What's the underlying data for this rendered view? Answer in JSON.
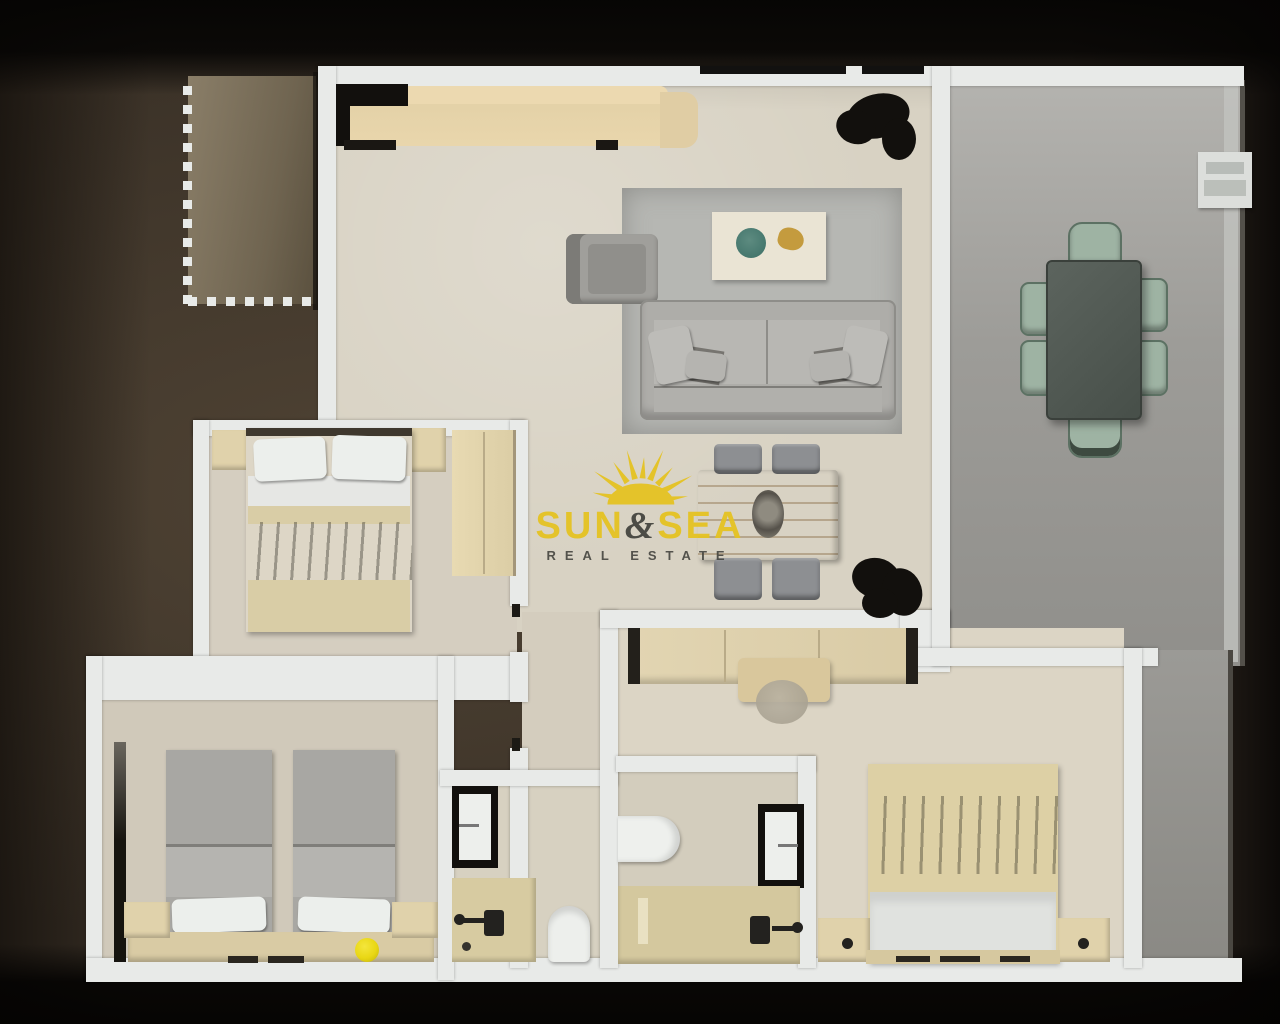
{
  "watermark": {
    "brand_word1": "SUN",
    "brand_amp": "&",
    "brand_word2": "SEA",
    "tagline": "REAL ESTATE"
  },
  "scene": {
    "description": "3D top-down floor plan render of an apartment",
    "rooms": [
      "living-dining-room",
      "kitchen",
      "terrace",
      "bedroom-left",
      "bedroom-bottom-left",
      "bedroom-bottom-right",
      "bathroom-1",
      "bathroom-2",
      "hallway",
      "outdoor-patio-patch"
    ]
  },
  "palette": {
    "bg_brown": "#3a3127",
    "black": "#12100d",
    "wall": "#e8eae8",
    "floor_living": "#d8d2c3",
    "floor_bedroom": "#d5cec0",
    "floor_terrace": "#a3a29e",
    "patch": "#7d7262",
    "rug": "#b6b7b3",
    "sofa": "#aeada9",
    "wood_table": "#cfa469",
    "kitchen_counter": "#e4d2a8",
    "chair_green": "#9eb3a3",
    "terrace_table": "#525a54",
    "olive": "#6b6753",
    "linen_white": "#e6e7e4",
    "furniture_beige": "#e0d2ab",
    "blanket_gray": "#a8a7a3",
    "lamp_yellow": "#e9d714",
    "logo_yellow": "#e5c322",
    "logo_dark": "#454540"
  }
}
